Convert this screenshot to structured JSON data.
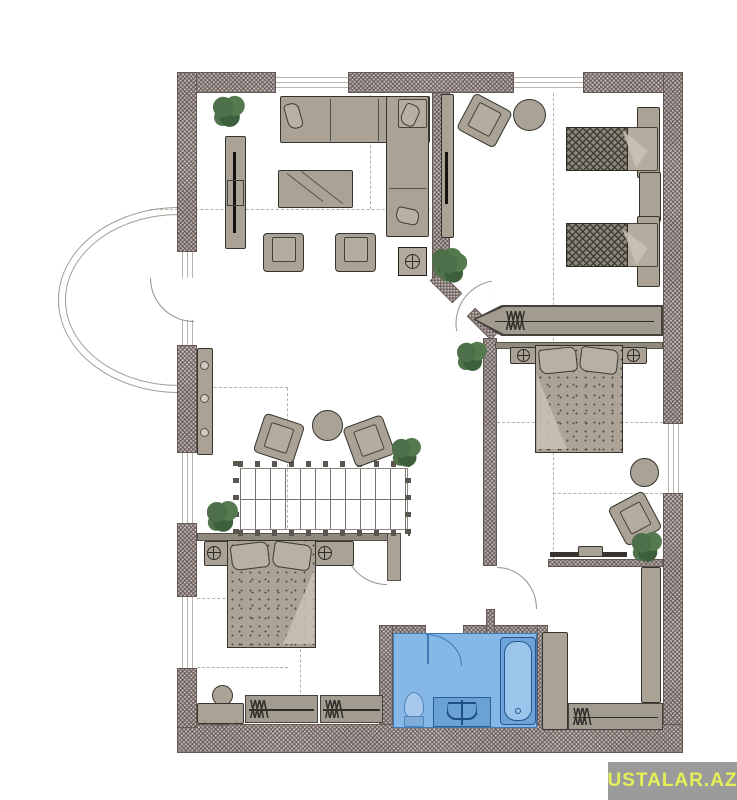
{
  "watermark": {
    "text": "USTALAR.AZ",
    "bg_color": "#9b9b9b",
    "text_color": "#e5f056"
  },
  "palette": {
    "wall_fill": "#c9c2be",
    "wall_hatch": "#584a48",
    "furniture": "#a9a295",
    "furniture_outline": "#35332d",
    "plant_green": "#4d6f49",
    "bath_floor": "#85b8e6",
    "bath_fixture": "#6aa2d4",
    "bath_outline": "#24588e",
    "dash_line": "#b5b0aa",
    "background": "#ffffff"
  },
  "plan": {
    "type": "attic-floor-plan",
    "rooms": [
      {
        "name": "living-room",
        "furniture": [
          "corner-sofa",
          "tv-stand",
          "coffee-table",
          "armchair",
          "armchair",
          "square-side-table",
          "plant"
        ]
      },
      {
        "name": "kids-bedroom",
        "furniture": [
          "single-bed",
          "single-bed",
          "nightstand",
          "tv-panel",
          "armchair",
          "round-table",
          "plant"
        ]
      },
      {
        "name": "master-bedroom",
        "furniture": [
          "double-bed",
          "nightstand",
          "nightstand",
          "wardrobe-rail",
          "pouf",
          "desk",
          "desk-chair",
          "plant"
        ]
      },
      {
        "name": "bedroom-2",
        "furniture": [
          "double-bed",
          "nightstand",
          "nightstand",
          "wardrobe-rail",
          "stool",
          "vanity-table"
        ]
      },
      {
        "name": "bathroom",
        "furniture": [
          "bathtub",
          "vanity-sink",
          "toilet"
        ]
      },
      {
        "name": "dressing-room",
        "furniture": [
          "cabinet",
          "cabinet",
          "wardrobe-rail"
        ]
      },
      {
        "name": "hall",
        "furniture": [
          "staircase",
          "armchair",
          "armchair",
          "round-table",
          "shelf-unit",
          "plant",
          "plant"
        ]
      }
    ],
    "features": [
      "bay-window",
      "windows",
      "door-swings",
      "roof-dash-lines"
    ]
  }
}
